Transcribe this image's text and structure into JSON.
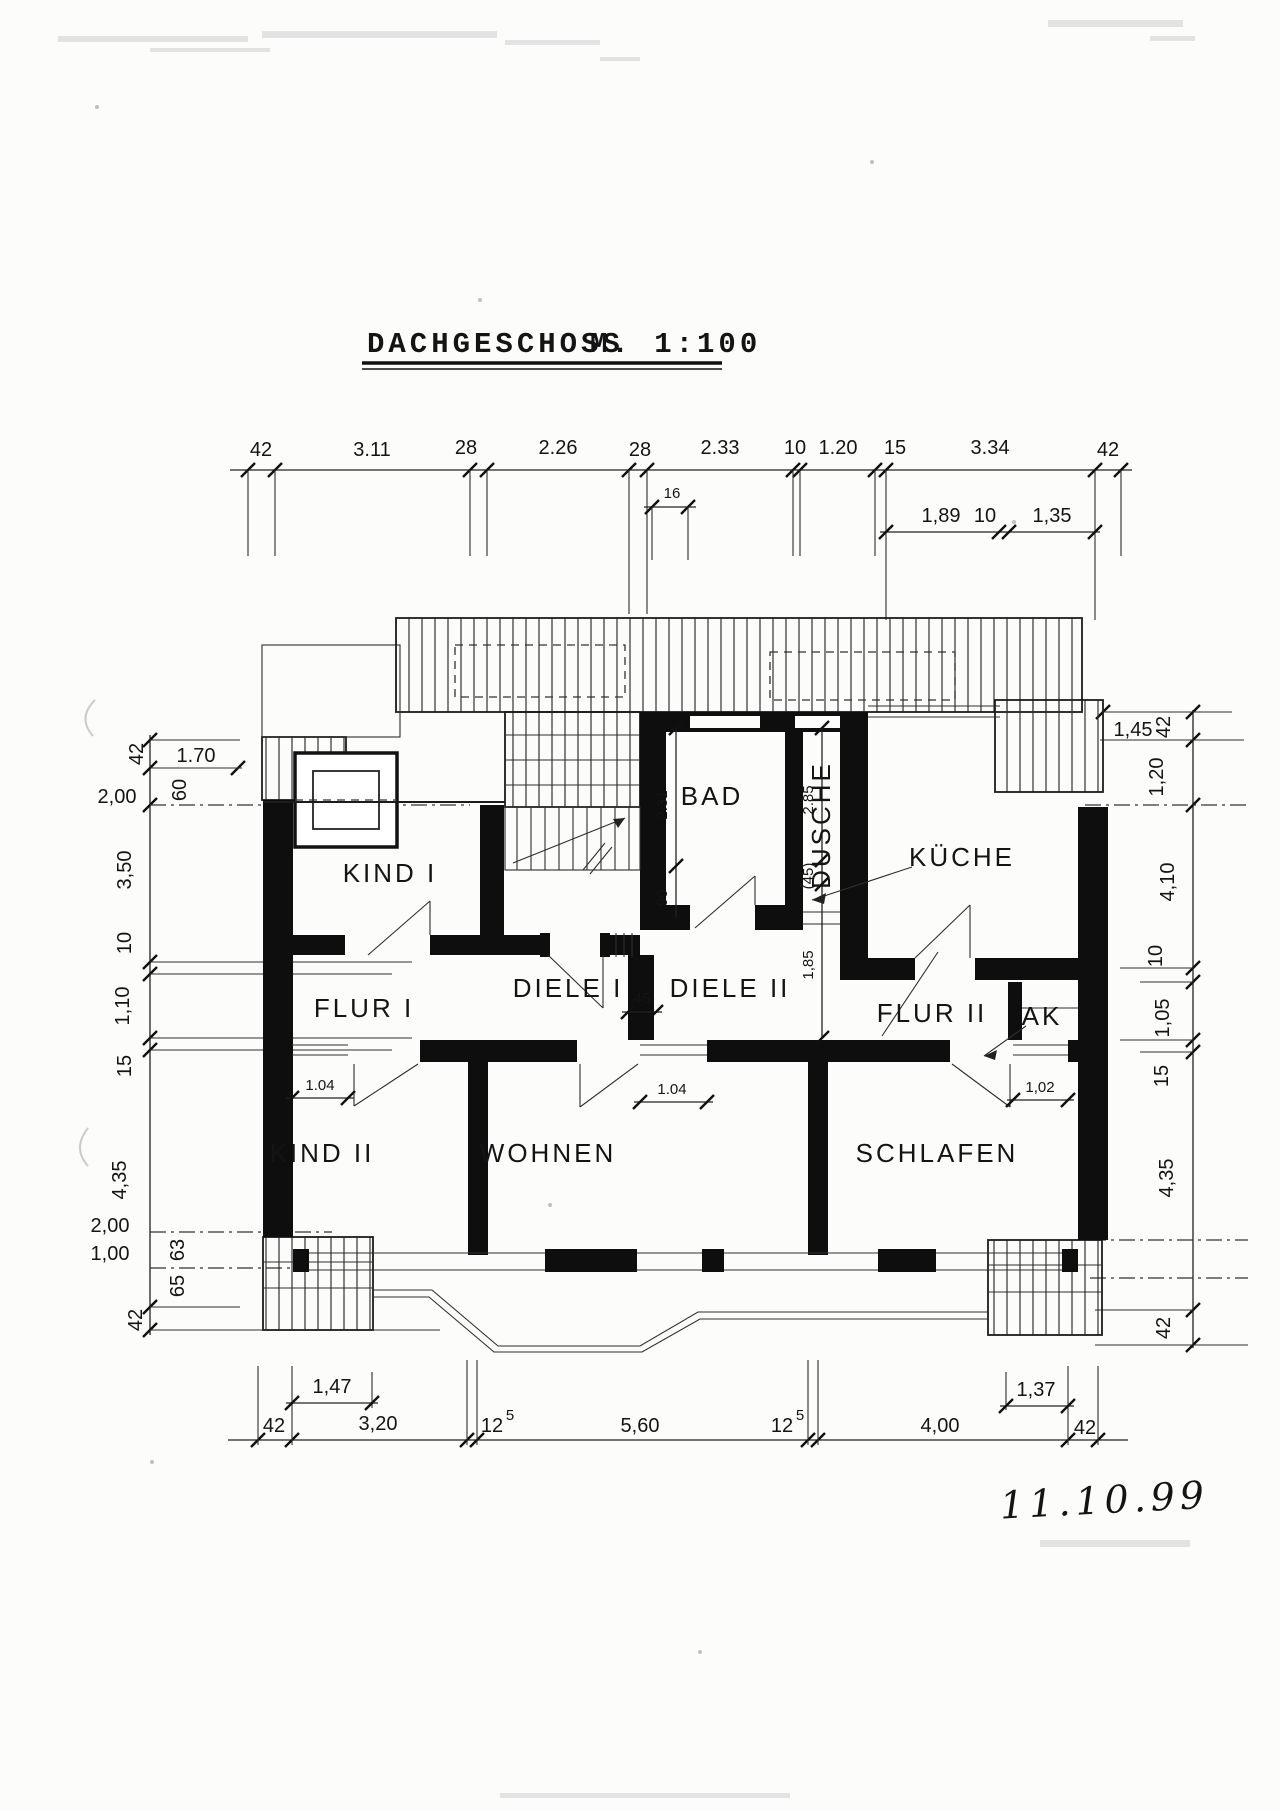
{
  "title": {
    "name": "DACHGESCHOSS",
    "scale": "M. 1:100"
  },
  "date": "11.10.99",
  "rooms": {
    "kind1": "KIND I",
    "bad": "BAD",
    "dusche": "DUSCHE",
    "kueche": "KÜCHE",
    "flur1": "FLUR I",
    "diele1": "DIELE I",
    "diele2": "DIELE II",
    "flur2": "FLUR II",
    "ak": "AK",
    "kind2": "KIND II",
    "wohnen": "WOHNEN",
    "schlafen": "SCHLAFEN"
  },
  "dims": {
    "top": [
      "42",
      "3.11",
      "28",
      "2.26",
      "28",
      "2.33",
      "10",
      "1.20",
      "15",
      "3.34",
      "42"
    ],
    "top_sub16": "16",
    "top_sub": [
      "1,89",
      "10",
      "1,35"
    ],
    "left": [
      "42",
      "1.70",
      "60",
      "2,00",
      "3,50",
      "10",
      "1,10",
      "15",
      "4,35",
      "2,00",
      "1,00",
      "63",
      "65",
      "42"
    ],
    "right": [
      "1,45",
      "42",
      "1,20",
      "4,10",
      "10",
      "1,05",
      "15",
      "4,35",
      "42"
    ],
    "bottom": [
      "42",
      "3,20",
      "12",
      "5",
      "5,60",
      "12",
      "5",
      "4,00",
      "42"
    ],
    "bottom_sub": [
      "1,47",
      "1,37"
    ],
    "interior": {
      "bad_depth": "2.31",
      "bad_door": "90",
      "dusche_depth": "2.85",
      "dusche_niche": "(45)",
      "diele2_width": "1,85",
      "diele_pass": "45",
      "kind2_window": "1.04",
      "wohnen_window": "1.04",
      "schlafen_window": "1,02"
    }
  }
}
